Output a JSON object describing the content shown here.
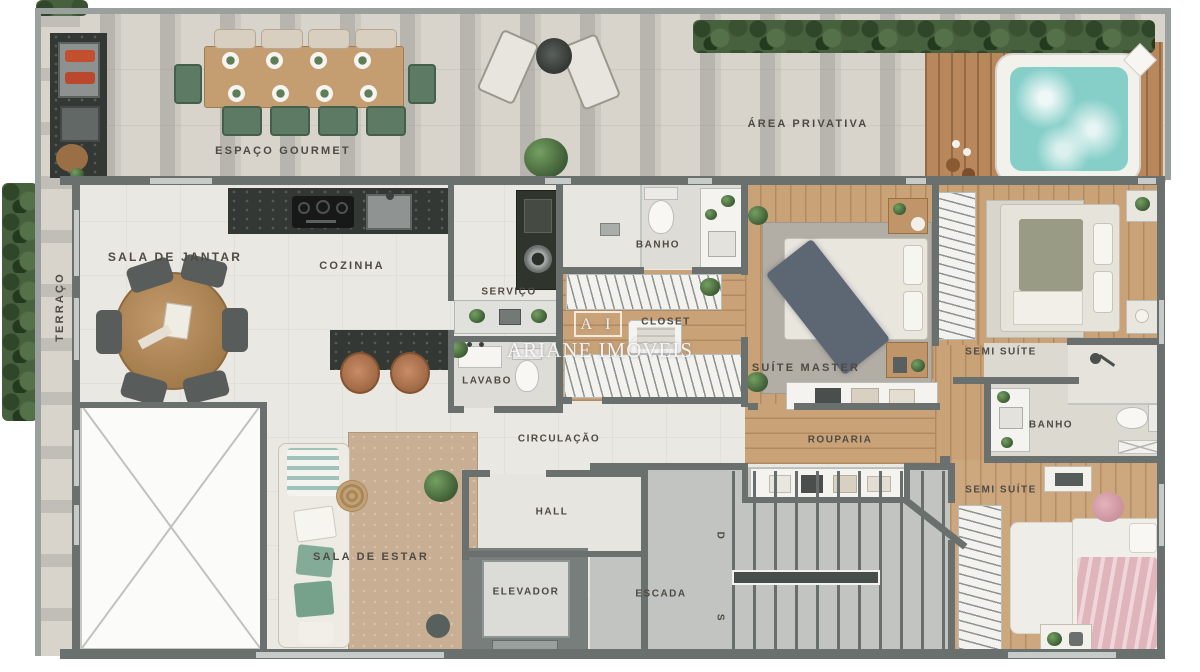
{
  "plan": {
    "type": "residential floor plan (top-down 3D render)",
    "watermark": {
      "logo": "A I",
      "name": "ARIANE IMÓVEIS"
    },
    "rooms": {
      "espaco_gourmet": "ESPAÇO GOURMET",
      "area_privativa": "ÁREA PRIVATIVA",
      "terraco": "TERRAÇO",
      "sala_de_jantar": "SALA DE JANTAR",
      "cozinha": "COZINHA",
      "servico": "SERVIÇO",
      "banho_suite": "BANHO",
      "closet": "CLOSET",
      "suite_master": "SUÍTE MASTER",
      "semi_suite_1": "SEMI SUÍTE",
      "lavabo": "LAVABO",
      "circulacao": "CIRCULAÇÃO",
      "rouparia": "ROUPARIA",
      "banho_semi": "BANHO",
      "hall": "HALL",
      "sala_de_estar": "SALA DE ESTAR",
      "elevador": "ELEVADOR",
      "escada": "ESCADA",
      "semi_suite_2": "SEMI SUÍTE"
    },
    "stairs": {
      "down_marker": "D",
      "up_marker": "S"
    },
    "colors": {
      "wall": "#6a706e",
      "terrace_tile": "#d8d4cb",
      "interior_floor": "#eae8e2",
      "wood_floor": "#c9a277",
      "deck_wood": "#b8875c",
      "jacuzzi_water": "#86cfc9",
      "hedge_green": "#47603e",
      "label_text": "#4e4a44"
    }
  }
}
